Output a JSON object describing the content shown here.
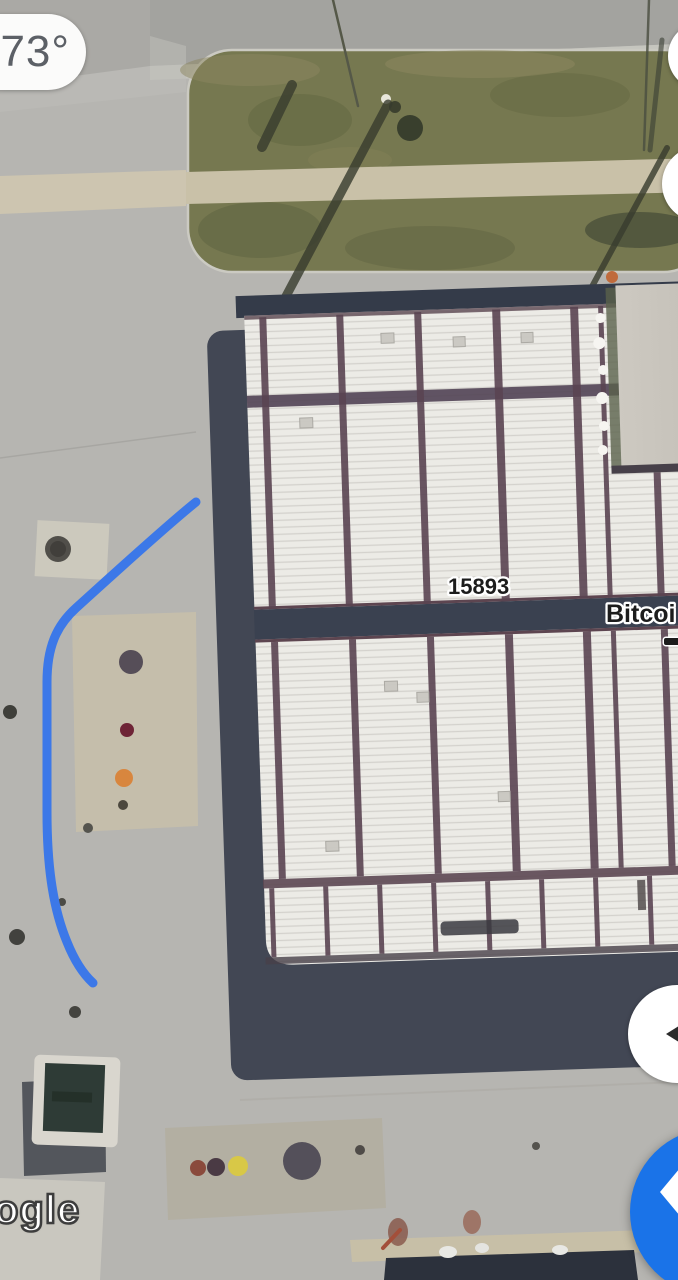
{
  "app": {
    "name": "Google Maps satellite view"
  },
  "weather_badge": {
    "temperature": "73°"
  },
  "map_labels": {
    "building_number": "15893",
    "poi_name_partial": "Bitcoi"
  },
  "watermark": {
    "text": "ogle"
  },
  "colors": {
    "route_blue": "#3C78E8",
    "primary_blue": "#1A73E8",
    "fab_arrow_white": "#FFFFFF",
    "side_arrow_dark": "#2B2B2B",
    "label_text": "#1C1C1C",
    "label_halo": "#FFFFFF",
    "roof_white": "#ECEBE6",
    "shadow_dark": "#424754"
  },
  "icons": {
    "fab_icon": "chevron-left-icon",
    "side_button_icon": "triangle-left-icon"
  }
}
